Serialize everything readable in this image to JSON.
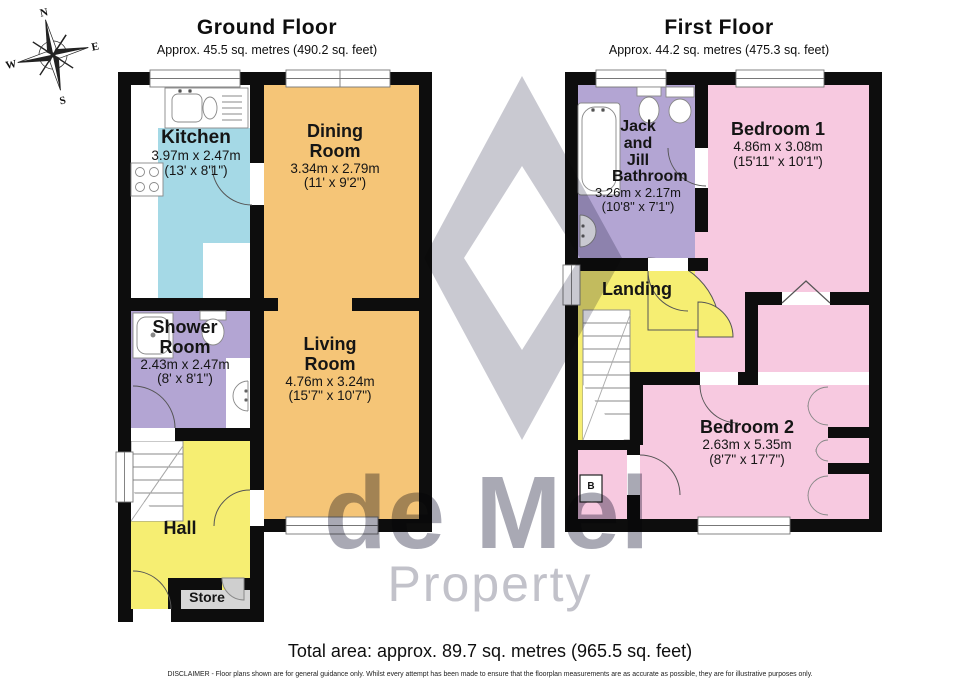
{
  "ground_floor": {
    "title": "Ground Floor",
    "subtitle": "Approx. 45.5 sq. metres (490.2 sq. feet)",
    "rooms": {
      "kitchen": {
        "name": "Kitchen",
        "metric": "3.97m x 2.47m",
        "imperial": "(13' x 8'1\")"
      },
      "dining_room": {
        "name": "Dining Room",
        "metric": "3.34m x 2.79m",
        "imperial": "(11' x 9'2\")"
      },
      "living_room": {
        "name": "Living Room",
        "metric": "4.76m x 3.24m",
        "imperial": "(15'7\" x 10'7\")"
      },
      "shower_room": {
        "name": "Shower Room",
        "metric": "2.43m x 2.47m",
        "imperial": "(8' x 8'1\")"
      },
      "hall": {
        "name": "Hall"
      },
      "store": {
        "name": "Store"
      }
    }
  },
  "first_floor": {
    "title": "First Floor",
    "subtitle": "Approx. 44.2 sq. metres (475.3 sq. feet)",
    "rooms": {
      "bathroom": {
        "name": "Jack and Jill Bathroom",
        "metric": "3.26m x 2.17m",
        "imperial": "(10'8\" x 7'1\")"
      },
      "bedroom_1": {
        "name": "Bedroom 1",
        "metric": "4.86m x 3.08m",
        "imperial": "(15'11\" x 10'1\")"
      },
      "bedroom_2": {
        "name": "Bedroom 2",
        "metric": "2.63m x 5.35m",
        "imperial": "(8'7\" x 17'7\")"
      },
      "landing": {
        "name": "Landing"
      },
      "boiler": {
        "label": "B"
      }
    }
  },
  "compass": {
    "north": "N",
    "east": "E",
    "south": "S",
    "west": "W"
  },
  "watermark": {
    "line1": "de Mel",
    "line2": "Property"
  },
  "footer": {
    "total_area": "Total area: approx. 89.7 sq. metres (965.5 sq. feet)",
    "disclaimer": "DISCLAIMER -  Floor plans shown are for general guidance only. Whilst every attempt has been made to ensure that the floorplan measurements are as accurate as possible, they are for illustrative purposes only."
  },
  "colors": {
    "kitchen": "#a5d9e6",
    "dining": "#f5c577",
    "living": "#f5c577",
    "shower": "#b3a5d3",
    "bathroom": "#b3a5d3",
    "hall": "#f6ee72",
    "landing": "#f6ee72",
    "bedroom": "#f7c9e0",
    "store": "#d6d6d6",
    "walls": "#0d0d0d",
    "watermark_diamond": "#c9c9d1",
    "watermark_text1": "#a9a9b4",
    "watermark_text2": "#c2c2ca"
  }
}
